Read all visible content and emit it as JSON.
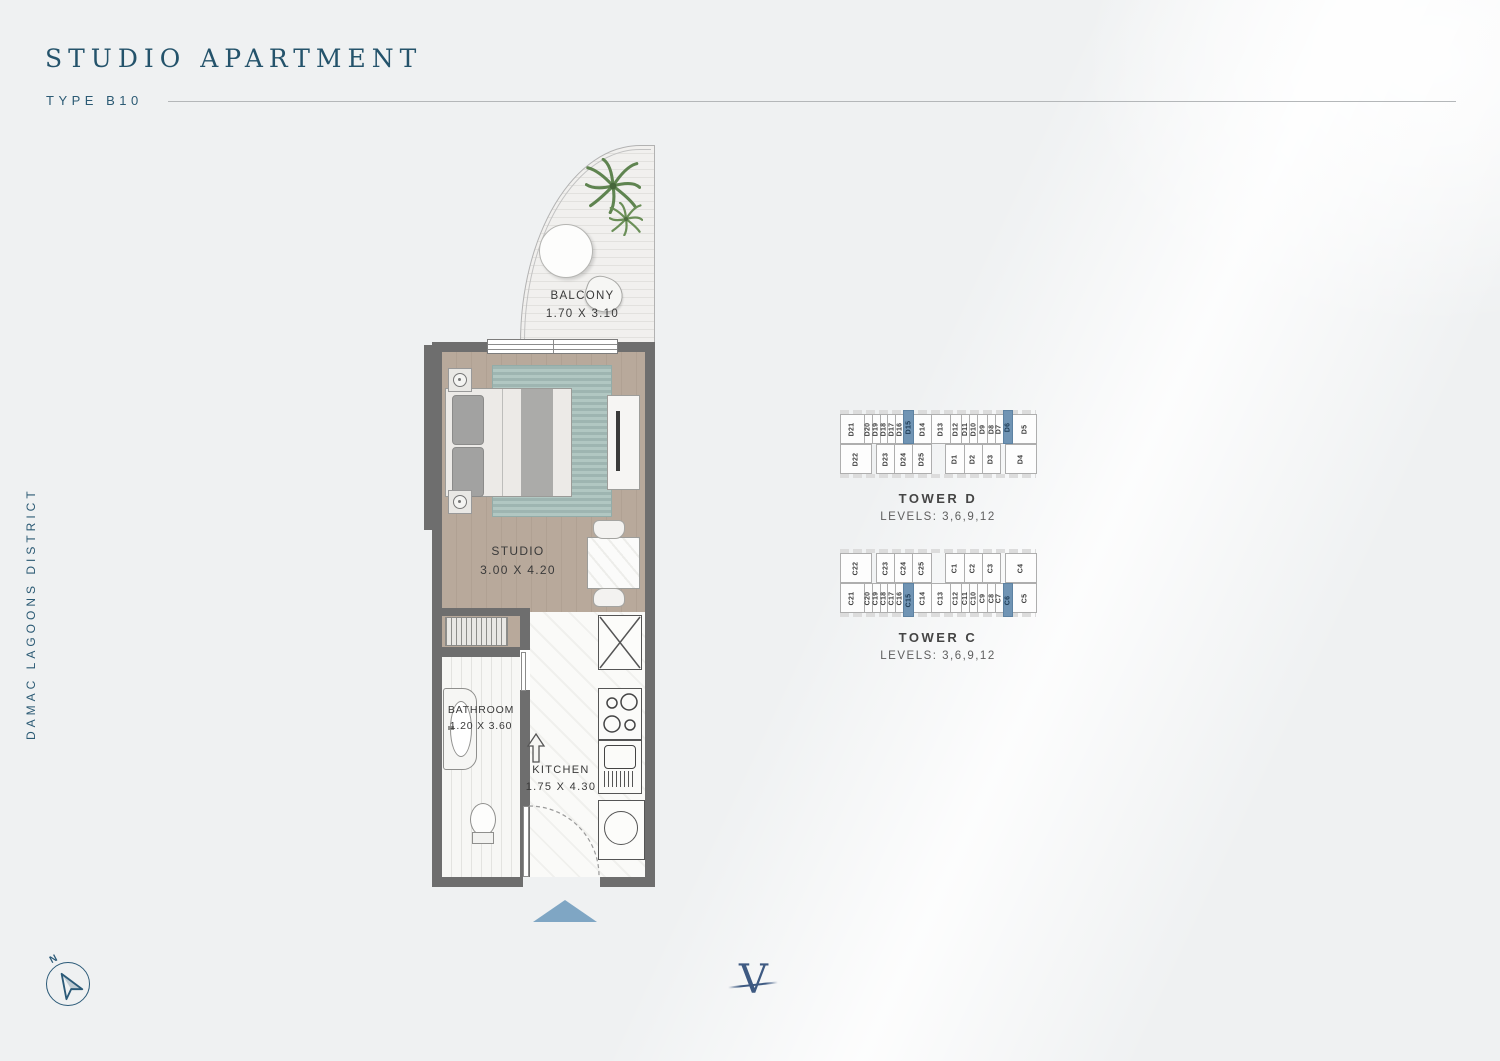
{
  "header": {
    "title": "STUDIO APARTMENT",
    "subtitle": "TYPE B10"
  },
  "side": {
    "label": "DAMAC LAGOONS DISTRICT"
  },
  "floorplan": {
    "balcony": {
      "label": "BALCONY",
      "dims": "1.70 X 3.10"
    },
    "studio": {
      "label": "STUDIO",
      "dims": "3.00 X 4.20"
    },
    "bathroom": {
      "label": "BATHROOM",
      "dims": "1.20 X 3.60"
    },
    "kitchen": {
      "label": "KITCHEN",
      "dims": "1.75 X 4.30"
    }
  },
  "towers": [
    {
      "name": "TOWER D",
      "levels": "LEVELS: 3,6,9,12",
      "top_row": [
        {
          "id": "D21",
          "w": 26
        },
        {
          "id": "D20",
          "w": 8
        },
        {
          "id": "D19",
          "w": 8
        },
        {
          "id": "D18",
          "w": 8
        },
        {
          "id": "D17",
          "w": 8
        },
        {
          "id": "D16",
          "w": 8
        },
        {
          "id": "D15",
          "w": 10,
          "hl": true
        },
        {
          "id": "D14",
          "w": 20
        },
        {
          "id": "D13",
          "w": 20
        },
        {
          "id": "D12",
          "w": 12
        },
        {
          "id": "D11",
          "w": 8
        },
        {
          "id": "D10",
          "w": 8
        },
        {
          "id": "D9",
          "w": 10
        },
        {
          "id": "D8",
          "w": 8
        },
        {
          "id": "D7",
          "w": 8
        },
        {
          "id": "D6",
          "w": 10,
          "hl": true
        },
        {
          "id": "D5",
          "w": 26
        }
      ],
      "bottom_row": [
        {
          "id": "D22",
          "w": 26
        },
        {
          "gap": 6
        },
        {
          "id": "D23",
          "w": 15
        },
        {
          "id": "D24",
          "w": 15
        },
        {
          "id": "D25",
          "w": 15
        },
        {
          "gap": 14
        },
        {
          "id": "D1",
          "w": 15
        },
        {
          "id": "D2",
          "w": 15
        },
        {
          "id": "D3",
          "w": 15
        },
        {
          "gap": 6
        },
        {
          "id": "D4",
          "w": 26
        }
      ],
      "highlighted_units": [
        "D15",
        "D6"
      ]
    },
    {
      "name": "TOWER C",
      "levels": "LEVELS: 3,6,9,12",
      "top_row": [
        {
          "id": "C22",
          "w": 26
        },
        {
          "gap": 6
        },
        {
          "id": "C23",
          "w": 15
        },
        {
          "id": "C24",
          "w": 15
        },
        {
          "id": "C25",
          "w": 15
        },
        {
          "gap": 14
        },
        {
          "id": "C1",
          "w": 15
        },
        {
          "id": "C2",
          "w": 15
        },
        {
          "id": "C3",
          "w": 15
        },
        {
          "gap": 6
        },
        {
          "id": "C4",
          "w": 26
        }
      ],
      "bottom_row": [
        {
          "id": "C21",
          "w": 26
        },
        {
          "id": "C20",
          "w": 8
        },
        {
          "id": "C19",
          "w": 8
        },
        {
          "id": "C18",
          "w": 8
        },
        {
          "id": "C17",
          "w": 8
        },
        {
          "id": "C16",
          "w": 8
        },
        {
          "id": "C15",
          "w": 10,
          "hl": true
        },
        {
          "id": "C14",
          "w": 20
        },
        {
          "id": "C13",
          "w": 20
        },
        {
          "id": "C12",
          "w": 12
        },
        {
          "id": "C11",
          "w": 8
        },
        {
          "id": "C10",
          "w": 8
        },
        {
          "id": "C9",
          "w": 10
        },
        {
          "id": "C8",
          "w": 8
        },
        {
          "id": "C7",
          "w": 8
        },
        {
          "id": "C6",
          "w": 10,
          "hl": true
        },
        {
          "id": "C5",
          "w": 26
        }
      ],
      "highlighted_units": [
        "C15",
        "C6"
      ]
    }
  ],
  "compass": {
    "label": "N"
  },
  "logo": {
    "letter": "V"
  },
  "colors": {
    "accent_navy": "#24536b",
    "wall_gray": "#6e6e6e",
    "floor_beige": "#b8a99b",
    "rug_teal": "#a6bfba",
    "highlight_blue": "#7094b4",
    "entry_arrow_blue": "#7fa6c4"
  }
}
